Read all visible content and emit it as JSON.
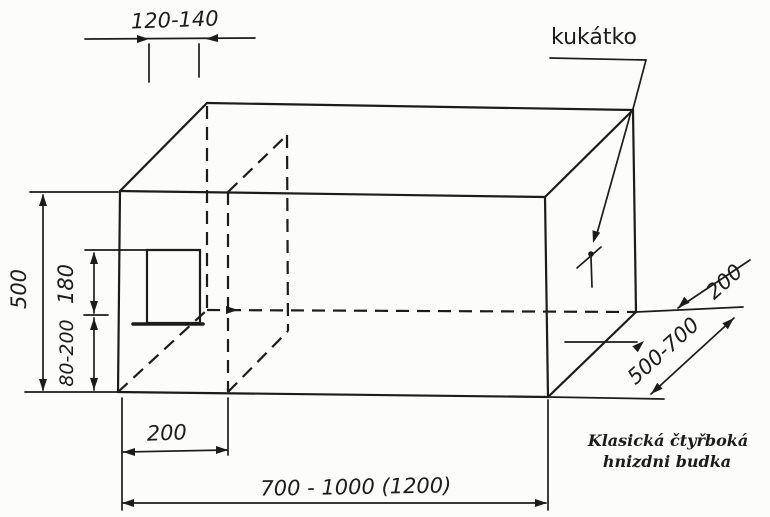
{
  "drawing": {
    "caption": {
      "line1": "Klasická čtyřboká",
      "line2": "hnizdni budka"
    },
    "labels": {
      "peephole": "kukátko"
    },
    "dimensions": {
      "entrance_width": "120-140",
      "box_height": "500",
      "entrance_height": "180",
      "entrance_bottom_offset": "80-200",
      "front_compartment_depth": "200",
      "box_length": "700 - 1000 (1200)",
      "box_depth": "500-700",
      "rear_offset": "200"
    },
    "colors": {
      "ink": "#1c1c1c",
      "paper": "#fcfcfa"
    }
  }
}
